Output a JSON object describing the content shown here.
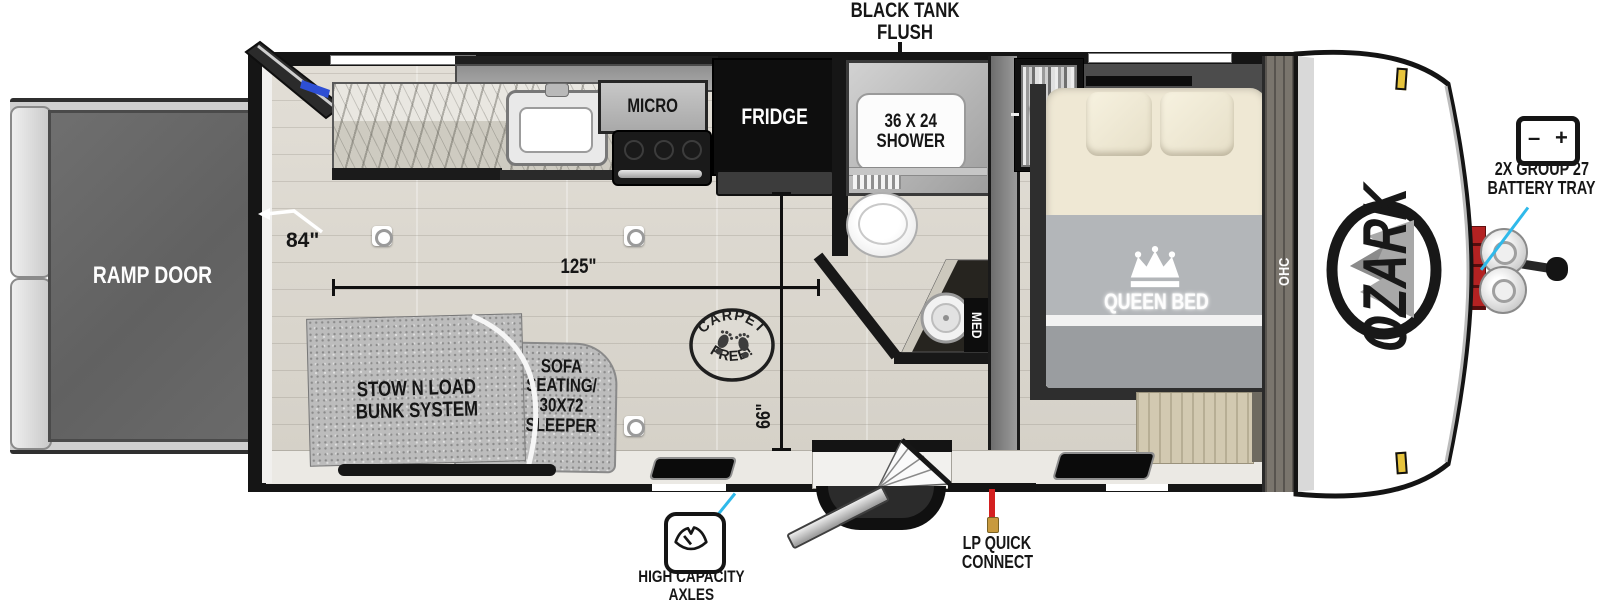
{
  "brand": "OZARK",
  "callouts": {
    "black_tank_flush_1": "BLACK TANK",
    "black_tank_flush_2": "FLUSH",
    "battery_line1": "2X GROUP 27",
    "battery_line2": "BATTERY TRAY",
    "battery_minus": "–",
    "battery_plus": "+",
    "lp_line1": "LP QUICK",
    "lp_line2": "CONNECT",
    "axles_line1": "HIGH CAPACITY",
    "axles_line2": "AXLES"
  },
  "rooms": {
    "ramp_door": "RAMP DOOR",
    "micro": "MICRO",
    "fridge": "FRIDGE",
    "shower_line1": "36 X 24",
    "shower_line2": "SHOWER",
    "ward": "WARD",
    "med": "MED",
    "ohc": "OHC",
    "queen_bed": "QUEEN BED",
    "stow_line1": "STOW N LOAD",
    "stow_line2": "BUNK SYSTEM",
    "sofa_line1": "SOFA",
    "sofa_line2": "SEATING/",
    "sofa_line3": "30X72",
    "sofa_line4": "SLEEPER"
  },
  "stamp": {
    "top": "CARPET",
    "bottom": "FREE!"
  },
  "dimensions": {
    "rear_opening": "84\"",
    "main_length": "125\"",
    "cross_width": "66\""
  },
  "colors": {
    "callout_line": "#2fb9ea",
    "lp_line": "#d42020",
    "clearance_light": "#e7c43c",
    "wall": "#151515"
  }
}
